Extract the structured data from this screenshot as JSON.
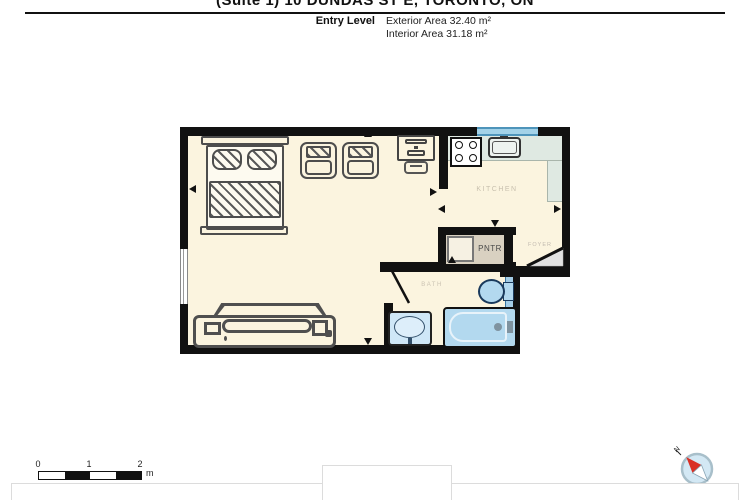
{
  "header": {
    "title": "(Suite 1) 10 DUNDAS ST E, TORONTO, ON",
    "level_label": "Entry Level",
    "exterior_area": "Exterior Area 32.40 m²",
    "interior_area": "Interior Area 31.18 m²"
  },
  "plan": {
    "rooms": {
      "kitchen": "KITCHEN",
      "pantry": "PNTR",
      "bath": "BATH",
      "foyer": "FOYER"
    },
    "furniture": [
      "bed",
      "armchair",
      "armchair",
      "desk",
      "stove",
      "kitchen-sink",
      "pantry-closet",
      "toilet",
      "vanity-sink",
      "bathtub",
      "sofa"
    ],
    "colors": {
      "floor": "#fbf4df",
      "wall": "#111111",
      "counter": "#dfe9e2",
      "window_blue": "#a3d2e8",
      "fixture_blue": "#b3d9ef",
      "pantry_tan": "#d9d1c1"
    }
  },
  "scale_bar": {
    "ticks": [
      "0",
      "1",
      "2"
    ],
    "unit": "m"
  },
  "compass": {
    "north_label": "N"
  }
}
